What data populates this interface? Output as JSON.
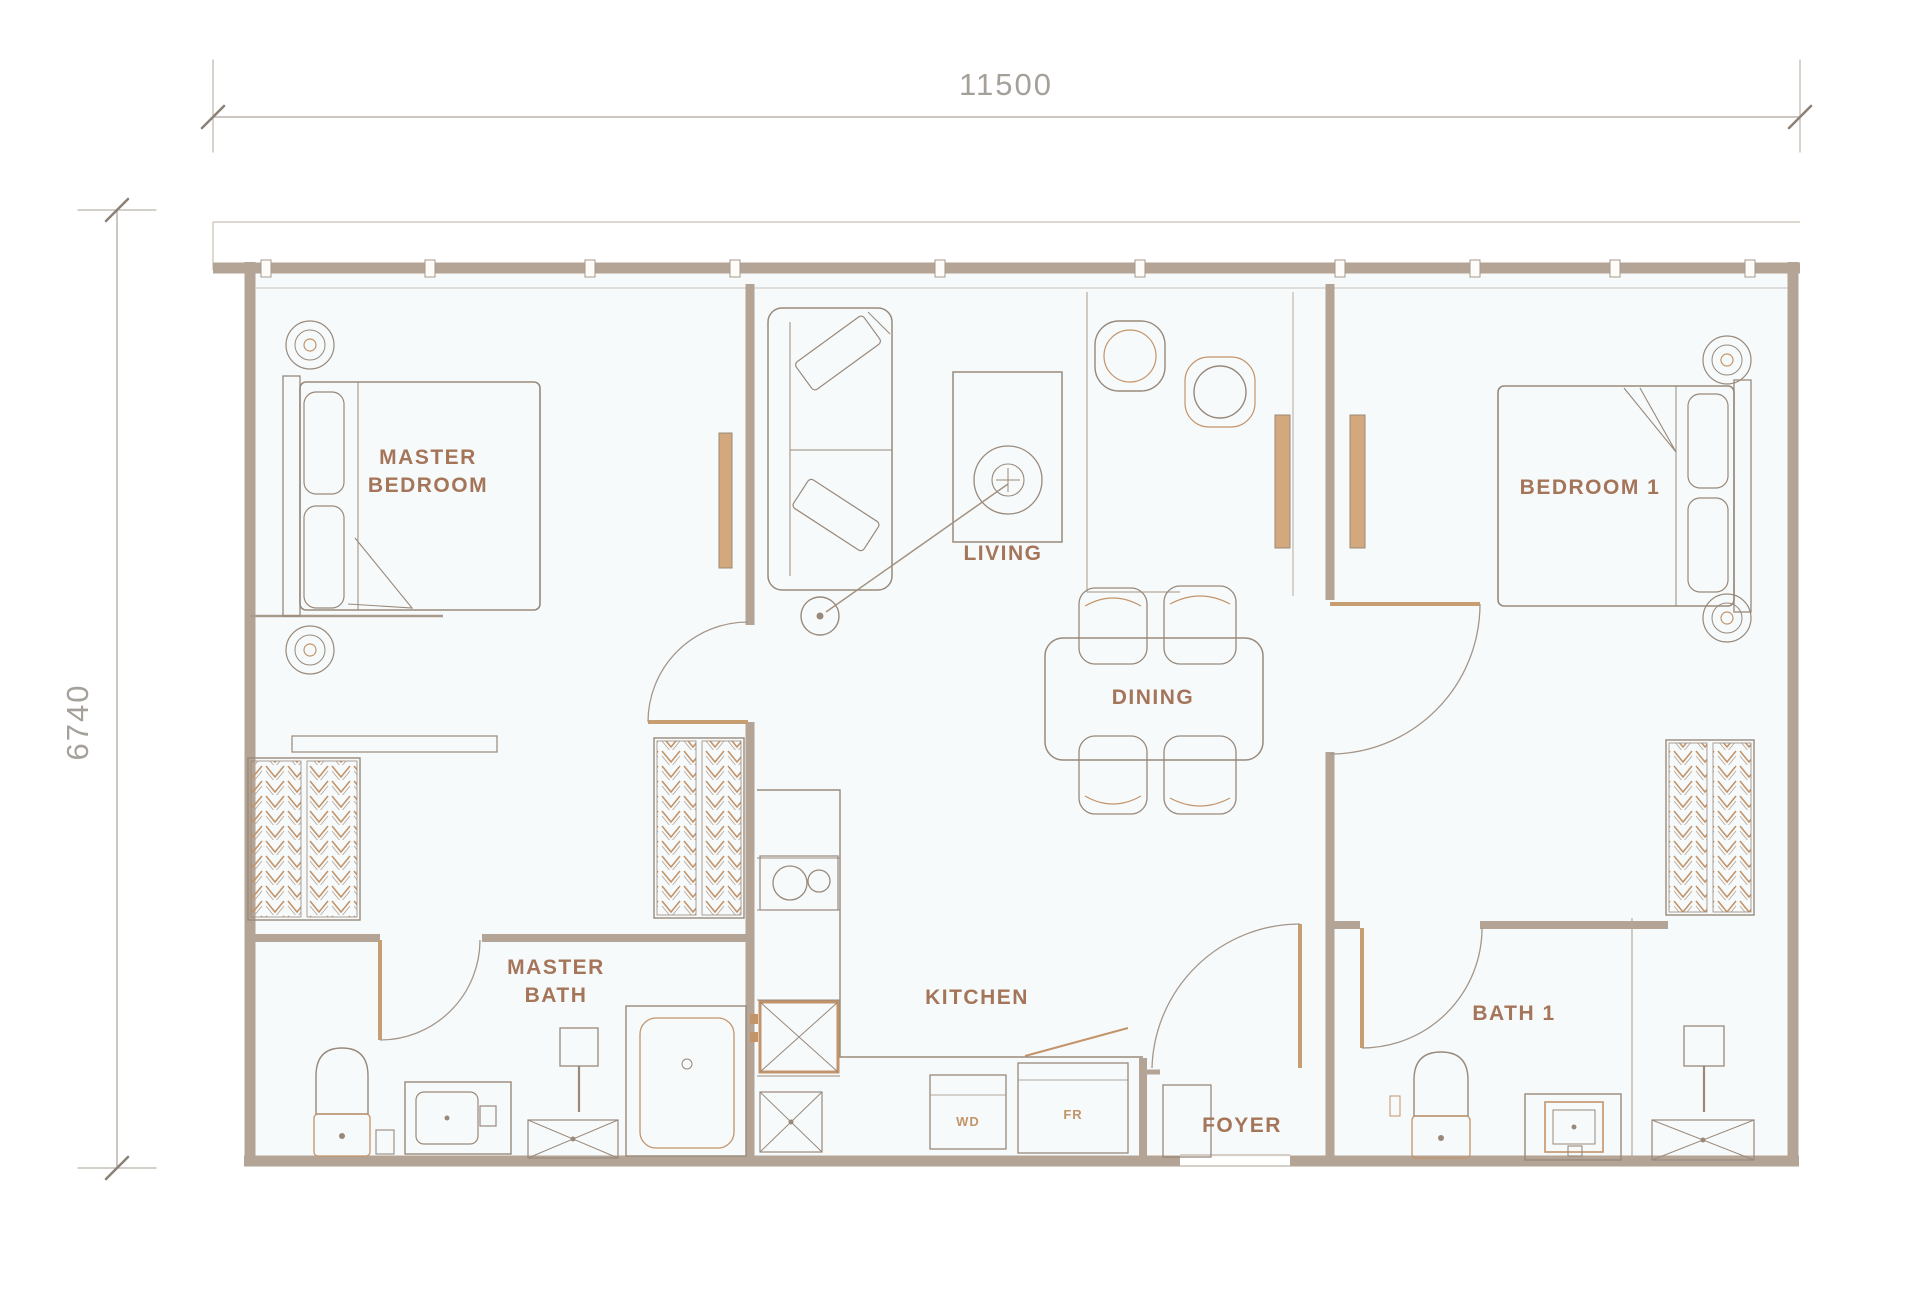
{
  "dimensions": {
    "top": "11500",
    "left": "6740"
  },
  "rooms": {
    "master_bedroom": {
      "line1": "MASTER",
      "line2": "BEDROOM"
    },
    "living": {
      "label": "LIVING"
    },
    "dining": {
      "label": "DINING"
    },
    "bedroom_1": {
      "label": "BEDROOM 1"
    },
    "master_bath": {
      "line1": "MASTER",
      "line2": "BATH"
    },
    "kitchen": {
      "label": "KITCHEN"
    },
    "bath_1": {
      "label": "BATH 1"
    },
    "foyer": {
      "label": "FOYER"
    }
  },
  "appliances": {
    "washer_dryer": "WD",
    "fridge": "FR"
  },
  "colors": {
    "wall": "#b3a496",
    "furniture_line": "#98897b",
    "accent": "#c3946a",
    "room_label": "#a5755a",
    "dimension_text": "#a5a19a"
  }
}
